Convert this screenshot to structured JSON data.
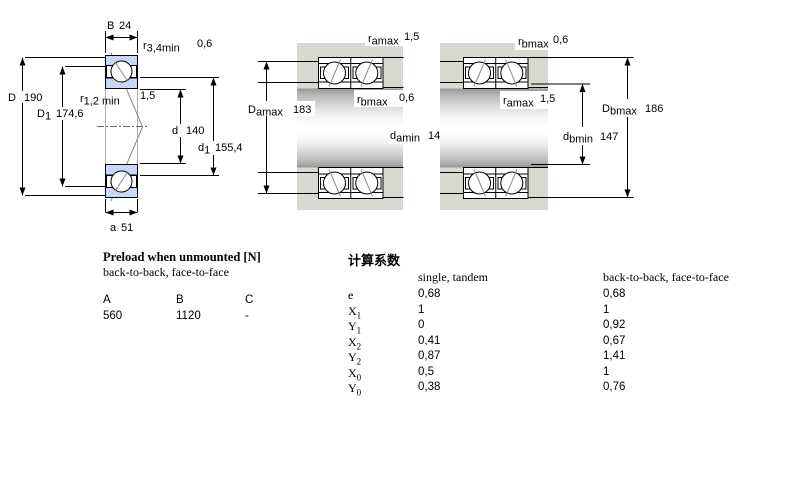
{
  "diagram": {
    "left": {
      "B": {
        "main": "B",
        "sub": "",
        "value": "24"
      },
      "r34": {
        "main": "r",
        "sub": "3,4min",
        "value": "0,6"
      },
      "D": {
        "main": "D",
        "sub": "",
        "value": "190"
      },
      "D1": {
        "main": "D",
        "sub": "1",
        "value": "174,6"
      },
      "r12": {
        "main": "r",
        "sub": "1,2 min",
        "value": "1,5"
      },
      "d": {
        "main": "d",
        "sub": "",
        "value": "140"
      },
      "d1": {
        "main": "d",
        "sub": "1",
        "value": "155,4"
      },
      "a": {
        "main": "a",
        "sub": "",
        "value": "51"
      }
    },
    "middle": {
      "ramax": {
        "main": "r",
        "sub": "amax",
        "value": "1,5"
      },
      "Damax": {
        "main": "D",
        "sub": "amax",
        "value": "183"
      },
      "rbmax": {
        "main": "r",
        "sub": "bmax",
        "value": "0,6"
      },
      "damin": {
        "main": "d",
        "sub": "amin",
        "value": "147"
      }
    },
    "right": {
      "rbmax": {
        "main": "r",
        "sub": "bmax",
        "value": "0,6"
      },
      "ramax": {
        "main": "r",
        "sub": "amax",
        "value": "1,5"
      },
      "Dbmax": {
        "main": "D",
        "sub": "bmax",
        "value": "186"
      },
      "dbmin": {
        "main": "d",
        "sub": "bmin",
        "value": "147"
      }
    }
  },
  "preload": {
    "title": "Preload when unmounted [N]",
    "subtitle": "back-to-back, face-to-face",
    "columns": [
      "A",
      "B",
      "C"
    ],
    "values": [
      "560",
      "1120",
      "-"
    ]
  },
  "factors": {
    "title": "计算系数",
    "col1_header": "single, tandem",
    "col2_header": "back-to-back, face-to-face",
    "rows": [
      {
        "label": "e",
        "sub": "",
        "single": "0,68",
        "btb": "0,68"
      },
      {
        "label": "X",
        "sub": "1",
        "single": "1",
        "btb": "1"
      },
      {
        "label": "Y",
        "sub": "1",
        "single": "0",
        "btb": "0,92"
      },
      {
        "label": "X",
        "sub": "2",
        "single": "0,41",
        "btb": "0,67"
      },
      {
        "label": "Y",
        "sub": "2",
        "single": "0,87",
        "btb": "1,41"
      },
      {
        "label": "X",
        "sub": "0",
        "single": "0,5",
        "btb": "1"
      },
      {
        "label": "Y",
        "sub": "0",
        "single": "0,38",
        "btb": "0,76"
      }
    ]
  },
  "colors": {
    "bearing_blue": "#cfd9f1",
    "bearing_blue_dot": "#b2c3e6",
    "band_gray": "#dbdbd3",
    "band_gray_dot": "#c9c9c1",
    "line_black": "#000000",
    "contact_gray": "#8b8b8b"
  }
}
